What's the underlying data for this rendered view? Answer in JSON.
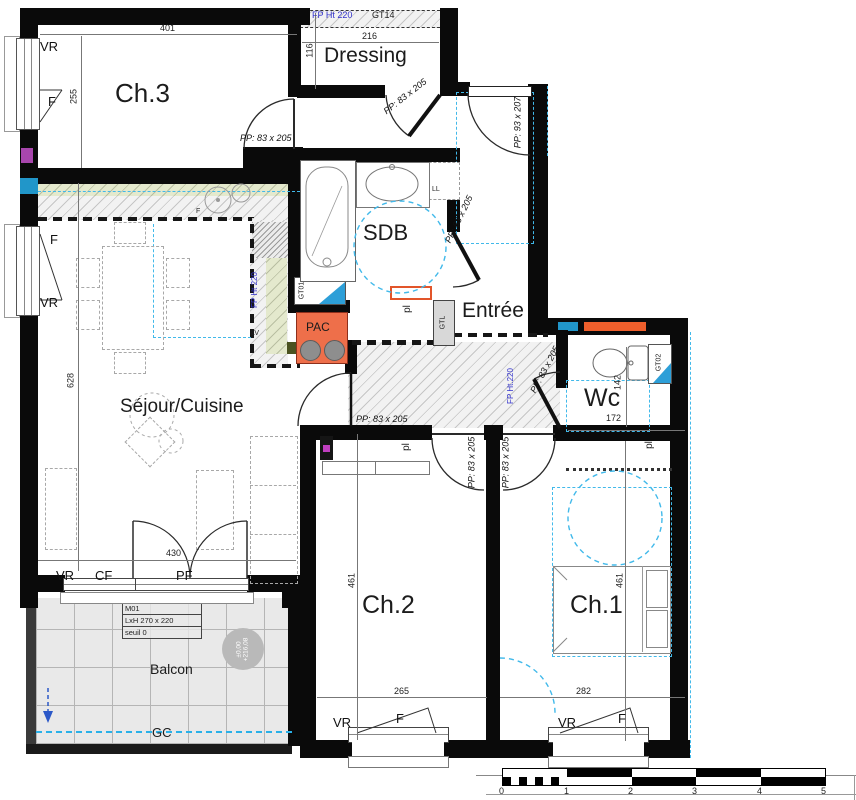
{
  "rooms": {
    "ch3": "Ch.3",
    "dressing": "Dressing",
    "sdb": "SDB",
    "entree": "Entrée",
    "wc": "Wc",
    "sejour": "Séjour/Cuisine",
    "ch2": "Ch.2",
    "ch1": "Ch.1",
    "pac": "PAC"
  },
  "doors": {
    "pp83": "PP: 83 x 205",
    "pp93": "PP: 93 x 207"
  },
  "windows": {
    "vr": "VR",
    "f": "F",
    "cf": "CF",
    "pf": "PF"
  },
  "dims": {
    "d401": "401",
    "d255": "255",
    "d216": "216",
    "d116": "116",
    "d628": "628",
    "d430": "430",
    "d265": "265",
    "d282": "282",
    "d461": "461",
    "d142": "142",
    "d172": "172"
  },
  "tech": {
    "fp_ht220": "FP Ht 220",
    "fp_ht220_dot": "FP Ht.220",
    "gt14": "GT14",
    "gt01": "GT01",
    "gt02": "GT02",
    "gtl": "GTL",
    "ll": "LL",
    "lv": "LV",
    "f_oven": "F",
    "pl": "pl",
    "gc": "GC"
  },
  "balcony": {
    "label": "Balcon",
    "m01": "M01",
    "lxh": "LxH   270 x 220",
    "seuil": "seuil  0",
    "level_top": "±0,00",
    "level_bottom": "+216,08"
  },
  "scale_bar": {
    "ticks": [
      "0",
      "1",
      "2",
      "3",
      "4",
      "5"
    ]
  },
  "colors": {
    "wall": "#0a0a0a",
    "cyan_dashed": "#41b9ea",
    "cyan_band": "#2196c9",
    "orange_pac": "#ee6f4a",
    "orange_band": "#ee5f2c",
    "kitchen_green": "#e4e9cd",
    "blue_text": "#3333cc",
    "purple_marker": "#a846ad",
    "gray_box": "#d8d8d8",
    "tile": "#e9e9e9",
    "arrow_blue": "#2b58c8"
  }
}
